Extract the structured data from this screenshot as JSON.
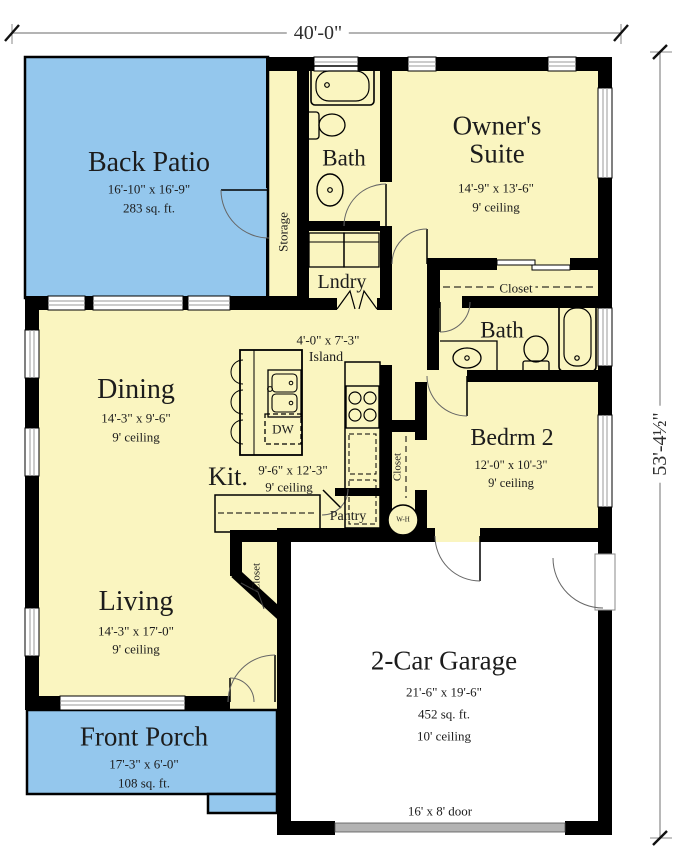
{
  "dimensions": {
    "top": "40'-0\"",
    "right": "53'-4½\""
  },
  "rooms": {
    "back_patio": {
      "name": "Back Patio",
      "size": "16'-10\" x 16'-9\"",
      "area": "283 sq. ft."
    },
    "storage": {
      "name": "Storage"
    },
    "bath1": {
      "name": "Bath"
    },
    "owners_suite": {
      "name": "Owner's Suite",
      "size": "14'-9\" x 13'-6\"",
      "ceiling": "9' ceiling"
    },
    "laundry": {
      "name": "Lndry"
    },
    "owners_closet": {
      "name": "Closet"
    },
    "bath2": {
      "name": "Bath"
    },
    "dining": {
      "name": "Dining",
      "size": "14'-3\" x 9'-6\"",
      "ceiling": "9' ceiling"
    },
    "island": {
      "name": "Island",
      "size": "4'-0\" x 7'-3\""
    },
    "kitchen": {
      "name": "Kit.",
      "size": "9'-6\" x 12'-3\"",
      "ceiling": "9' ceiling"
    },
    "dishwasher": {
      "name": "DW"
    },
    "bedroom2": {
      "name": "Bedrm 2",
      "size": "12'-0\" x 10'-3\"",
      "ceiling": "9' ceiling"
    },
    "bedroom2_closet": {
      "name": "Closet"
    },
    "pantry": {
      "name": "Pantry"
    },
    "water_heater": {
      "name": "W-H"
    },
    "living": {
      "name": "Living",
      "size": "14'-3\" x 17'-0\"",
      "ceiling": "9' ceiling"
    },
    "entry_closet": {
      "name": "Closet"
    },
    "garage": {
      "name": "2-Car Garage",
      "size": "21'-6\" x 19'-6\"",
      "area": "452 sq. ft.",
      "ceiling": "10' ceiling"
    },
    "front_porch": {
      "name": "Front Porch",
      "size": "17'-3\" x 6'-0\"",
      "area": "108 sq. ft."
    },
    "garage_door": {
      "label": "16' x 8' door"
    }
  },
  "colors": {
    "wall": "#000000",
    "room_fill": "#FAF5C0",
    "outdoor_fill": "#94C7ED",
    "garage_fill": "#FFFFFF",
    "garage_door": "#B3B3B3"
  }
}
